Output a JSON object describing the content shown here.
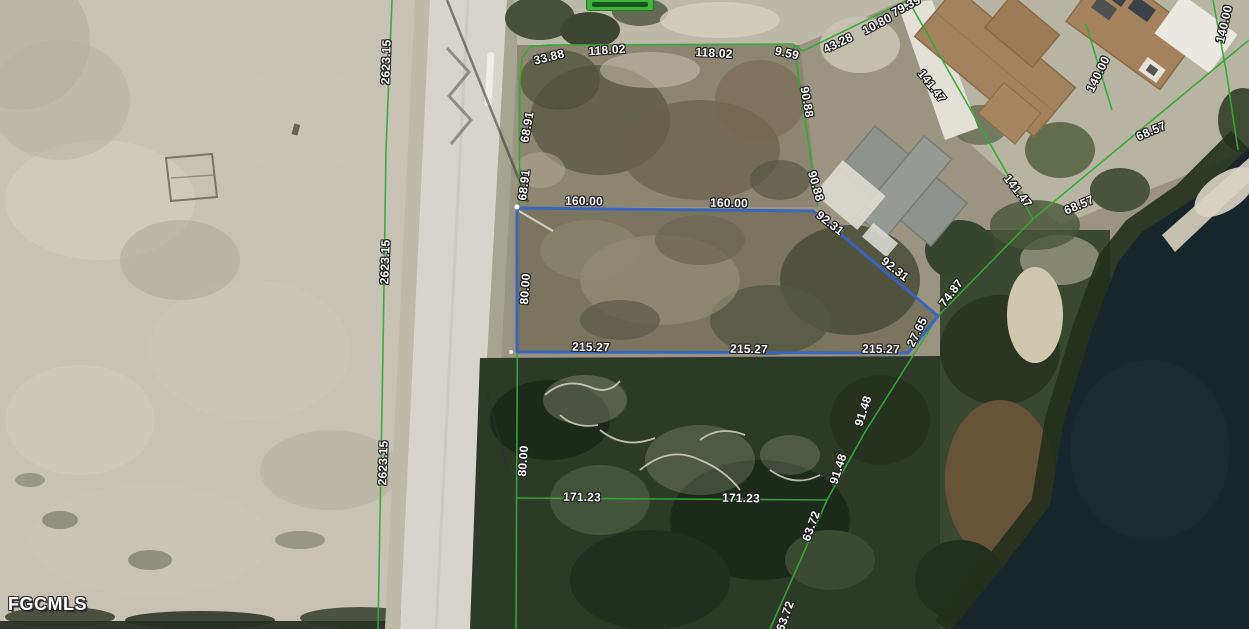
{
  "watermark": {
    "text": "FGCMLS"
  },
  "street_badge": {
    "text": ""
  },
  "colors": {
    "boundary_green": "#35a835",
    "parcel_blue": "#3a63c2",
    "label_text": "#ffffff",
    "label_outline": "#1f1f1f",
    "badge_green": "#3db23d"
  },
  "subject_parcel": {
    "frontage": "160.00",
    "depth": "215.27",
    "west_side": "80.00",
    "northeast_side": "92.31",
    "southeast_side": "27.65"
  },
  "dimension_labels": [
    {
      "text": "2623.15",
      "x": 386,
      "y": 62,
      "rot": -88
    },
    {
      "text": "2623.15",
      "x": 385,
      "y": 262,
      "rot": -88
    },
    {
      "text": "2623.15",
      "x": 383,
      "y": 463,
      "rot": -88
    },
    {
      "text": "33.88",
      "x": 549,
      "y": 57,
      "rot": -14
    },
    {
      "text": "118.02",
      "x": 607,
      "y": 50,
      "rot": -4
    },
    {
      "text": "118.02",
      "x": 714,
      "y": 53,
      "rot": 3
    },
    {
      "text": "9.59",
      "x": 787,
      "y": 53,
      "rot": 12
    },
    {
      "text": "43.28",
      "x": 838,
      "y": 43,
      "rot": -26
    },
    {
      "text": "10.80",
      "x": 877,
      "y": 24,
      "rot": -28
    },
    {
      "text": "79.39",
      "x": 906,
      "y": 6,
      "rot": -28
    },
    {
      "text": "68.91",
      "x": 527,
      "y": 127,
      "rot": -80
    },
    {
      "text": "68.91",
      "x": 524,
      "y": 185,
      "rot": -83
    },
    {
      "text": "90.88",
      "x": 807,
      "y": 102,
      "rot": 80
    },
    {
      "text": "90.88",
      "x": 816,
      "y": 186,
      "rot": 74
    },
    {
      "text": "141.47",
      "x": 932,
      "y": 86,
      "rot": 52
    },
    {
      "text": "141.47",
      "x": 1018,
      "y": 191,
      "rot": 52
    },
    {
      "text": "140.00",
      "x": 1098,
      "y": 74,
      "rot": -64
    },
    {
      "text": "140.00",
      "x": 1224,
      "y": 24,
      "rot": -77
    },
    {
      "text": "68.57",
      "x": 1151,
      "y": 131,
      "rot": -23
    },
    {
      "text": "68.57",
      "x": 1079,
      "y": 205,
      "rot": -23
    },
    {
      "text": "74.87",
      "x": 951,
      "y": 293,
      "rot": -53
    },
    {
      "text": "92.31",
      "x": 830,
      "y": 223,
      "rot": 38
    },
    {
      "text": "92.31",
      "x": 895,
      "y": 269,
      "rot": 38
    },
    {
      "text": "160.00",
      "x": 584,
      "y": 201,
      "rot": 1
    },
    {
      "text": "160.00",
      "x": 729,
      "y": 203,
      "rot": 1
    },
    {
      "text": "80.00",
      "x": 525,
      "y": 289,
      "rot": -86
    },
    {
      "text": "80.00",
      "x": 523,
      "y": 461,
      "rot": -86
    },
    {
      "text": "215.27",
      "x": 591,
      "y": 347,
      "rot": 1
    },
    {
      "text": "215.27",
      "x": 749,
      "y": 349,
      "rot": 1
    },
    {
      "text": "215.27",
      "x": 881,
      "y": 349,
      "rot": 1
    },
    {
      "text": "27.65",
      "x": 917,
      "y": 332,
      "rot": -64
    },
    {
      "text": "171.23",
      "x": 582,
      "y": 497,
      "rot": 1
    },
    {
      "text": "171.23",
      "x": 741,
      "y": 498,
      "rot": 1
    },
    {
      "text": "91.48",
      "x": 863,
      "y": 411,
      "rot": -72
    },
    {
      "text": "91.48",
      "x": 838,
      "y": 469,
      "rot": -72
    },
    {
      "text": "63.72",
      "x": 811,
      "y": 526,
      "rot": -70
    },
    {
      "text": "63.72",
      "x": 785,
      "y": 616,
      "rot": -70
    }
  ]
}
